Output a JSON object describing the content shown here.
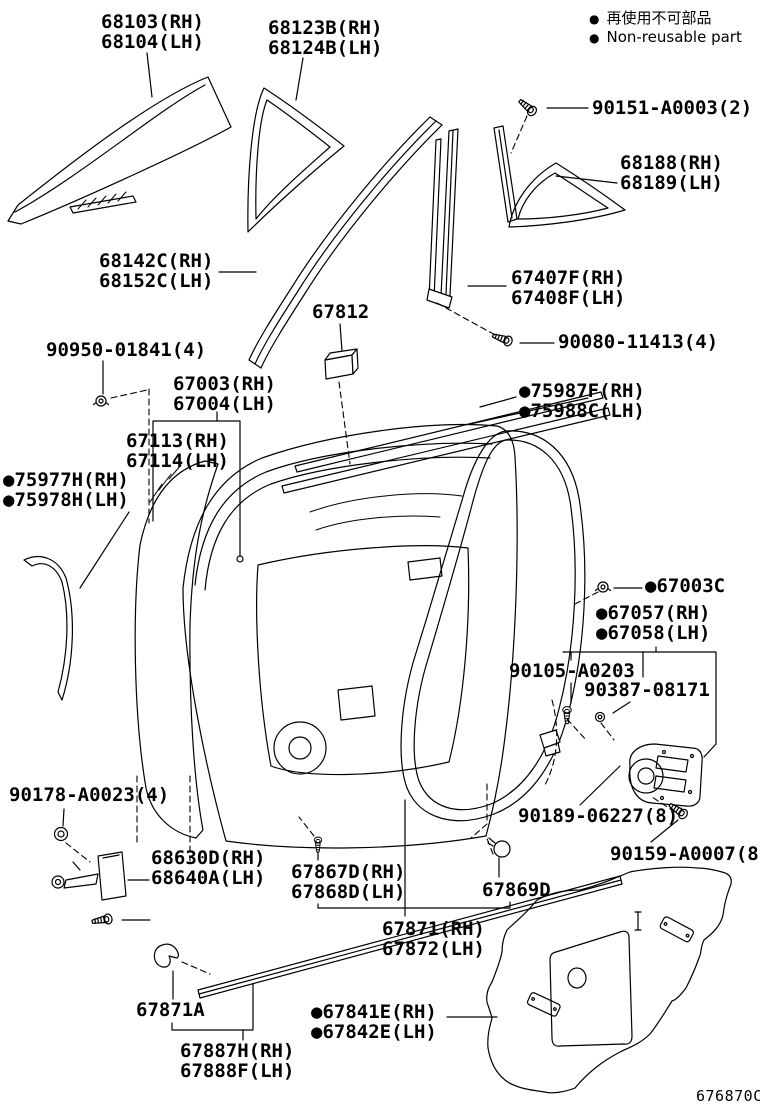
{
  "page": {
    "title": "Rear door panel & glass parts diagram",
    "figure_code": "676870C",
    "colors": {
      "line": "#000000",
      "background": "#ffffff"
    }
  },
  "legend": {
    "items": [
      {
        "bullet": "●",
        "text": "再使用不可部品"
      },
      {
        "bullet": "●",
        "text": "Non-reusable part"
      }
    ]
  },
  "labels": [
    {
      "part": "68103-68104",
      "lines": [
        "68103(RH)",
        "68104(LH)"
      ]
    },
    {
      "part": "68123B-68124B",
      "lines": [
        "68123B(RH)",
        "68124B(LH)"
      ]
    },
    {
      "part": "90151-A0003",
      "lines": [
        "90151-A0003(2)"
      ]
    },
    {
      "part": "68188-68189",
      "lines": [
        "68188(RH)",
        "68189(LH)"
      ]
    },
    {
      "part": "68142C-68152C",
      "lines": [
        "68142C(RH)",
        "68152C(LH)"
      ]
    },
    {
      "part": "67407F-67408F",
      "lines": [
        "67407F(RH)",
        "67408F(LH)"
      ]
    },
    {
      "part": "67812",
      "lines": [
        "67812"
      ]
    },
    {
      "part": "90080-11413",
      "lines": [
        "90080-11413(4)"
      ]
    },
    {
      "part": "90950-01841",
      "lines": [
        "90950-01841(4)"
      ]
    },
    {
      "part": "67003-67004",
      "lines": [
        "67003(RH)",
        "67004(LH)"
      ]
    },
    {
      "part": "75987F-75988C",
      "lines": [
        "●75987F(RH)",
        "●75988C(LH)"
      ],
      "non_reusable": true
    },
    {
      "part": "67113-67114",
      "lines": [
        "67113(RH)",
        "67114(LH)"
      ]
    },
    {
      "part": "75977H-75978H",
      "lines": [
        "●75977H(RH)",
        "●75978H(LH)"
      ],
      "non_reusable": true
    },
    {
      "part": "67003C",
      "lines": [
        "●67003C"
      ],
      "non_reusable": true
    },
    {
      "part": "67057-67058",
      "lines": [
        "●67057(RH)",
        "●67058(LH)"
      ],
      "non_reusable": true
    },
    {
      "part": "90105-A0203",
      "lines": [
        "90105-A0203"
      ]
    },
    {
      "part": "90387-08171",
      "lines": [
        "90387-08171"
      ]
    },
    {
      "part": "90178-A0023",
      "lines": [
        "90178-A0023(4)"
      ]
    },
    {
      "part": "90189-06227",
      "lines": [
        "90189-06227(8)"
      ]
    },
    {
      "part": "90159-A0007",
      "lines": [
        "90159-A0007(8)"
      ]
    },
    {
      "part": "68630D-68640A",
      "lines": [
        "68630D(RH)",
        "68640A(LH)"
      ]
    },
    {
      "part": "67867D-67868D",
      "lines": [
        "67867D(RH)",
        "67868D(LH)"
      ]
    },
    {
      "part": "67869D",
      "lines": [
        "67869D"
      ]
    },
    {
      "part": "67871-67872",
      "lines": [
        "67871(RH)",
        "67872(LH)"
      ]
    },
    {
      "part": "67871A",
      "lines": [
        "67871A"
      ]
    },
    {
      "part": "67841E-67842E",
      "lines": [
        "●67841E(RH)",
        "●67842E(LH)"
      ],
      "non_reusable": true
    },
    {
      "part": "67887H-67888F",
      "lines": [
        "67887H(RH)",
        "67888F(LH)"
      ]
    }
  ]
}
